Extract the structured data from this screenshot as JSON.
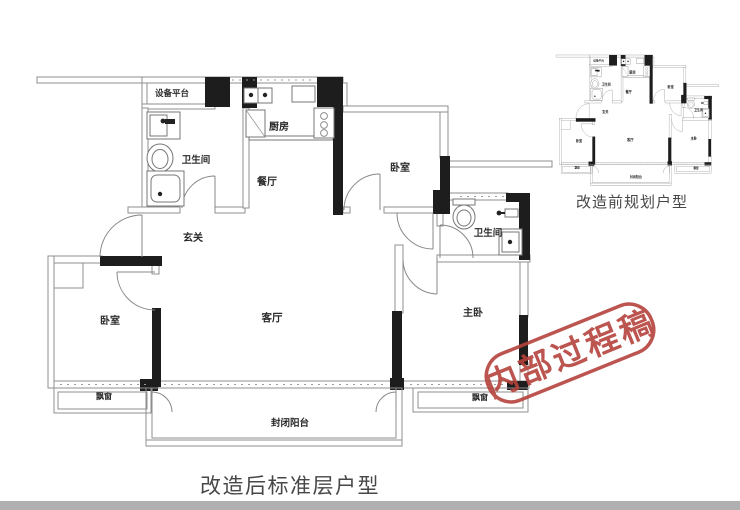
{
  "main_plan": {
    "caption": "改造后标准层户型",
    "rooms": {
      "equipment_platform": "设备平台",
      "bathroom_1": "卫生间",
      "kitchen": "厨房",
      "dining": "餐厅",
      "entry": "玄关",
      "bedroom_top": "卧室",
      "bedroom_left": "卧室",
      "living": "客厅",
      "bathroom_2": "卫生间",
      "master_bedroom": "主卧",
      "bay_window_left": "飘窗",
      "bay_window_right": "飘窗",
      "balcony": "封闭阳台"
    }
  },
  "thumbnail": {
    "caption": "改造前规划户型"
  },
  "stamp": {
    "text": "内部过程稿",
    "color": "#b5423c"
  },
  "colors": {
    "wall_dark": "#1d1d1d",
    "wall_line": "#8f8f8f",
    "label_text": "#2b2b2b",
    "caption_text": "#474747",
    "footer_bar": "#b0b0b0",
    "background": "#ffffff"
  }
}
